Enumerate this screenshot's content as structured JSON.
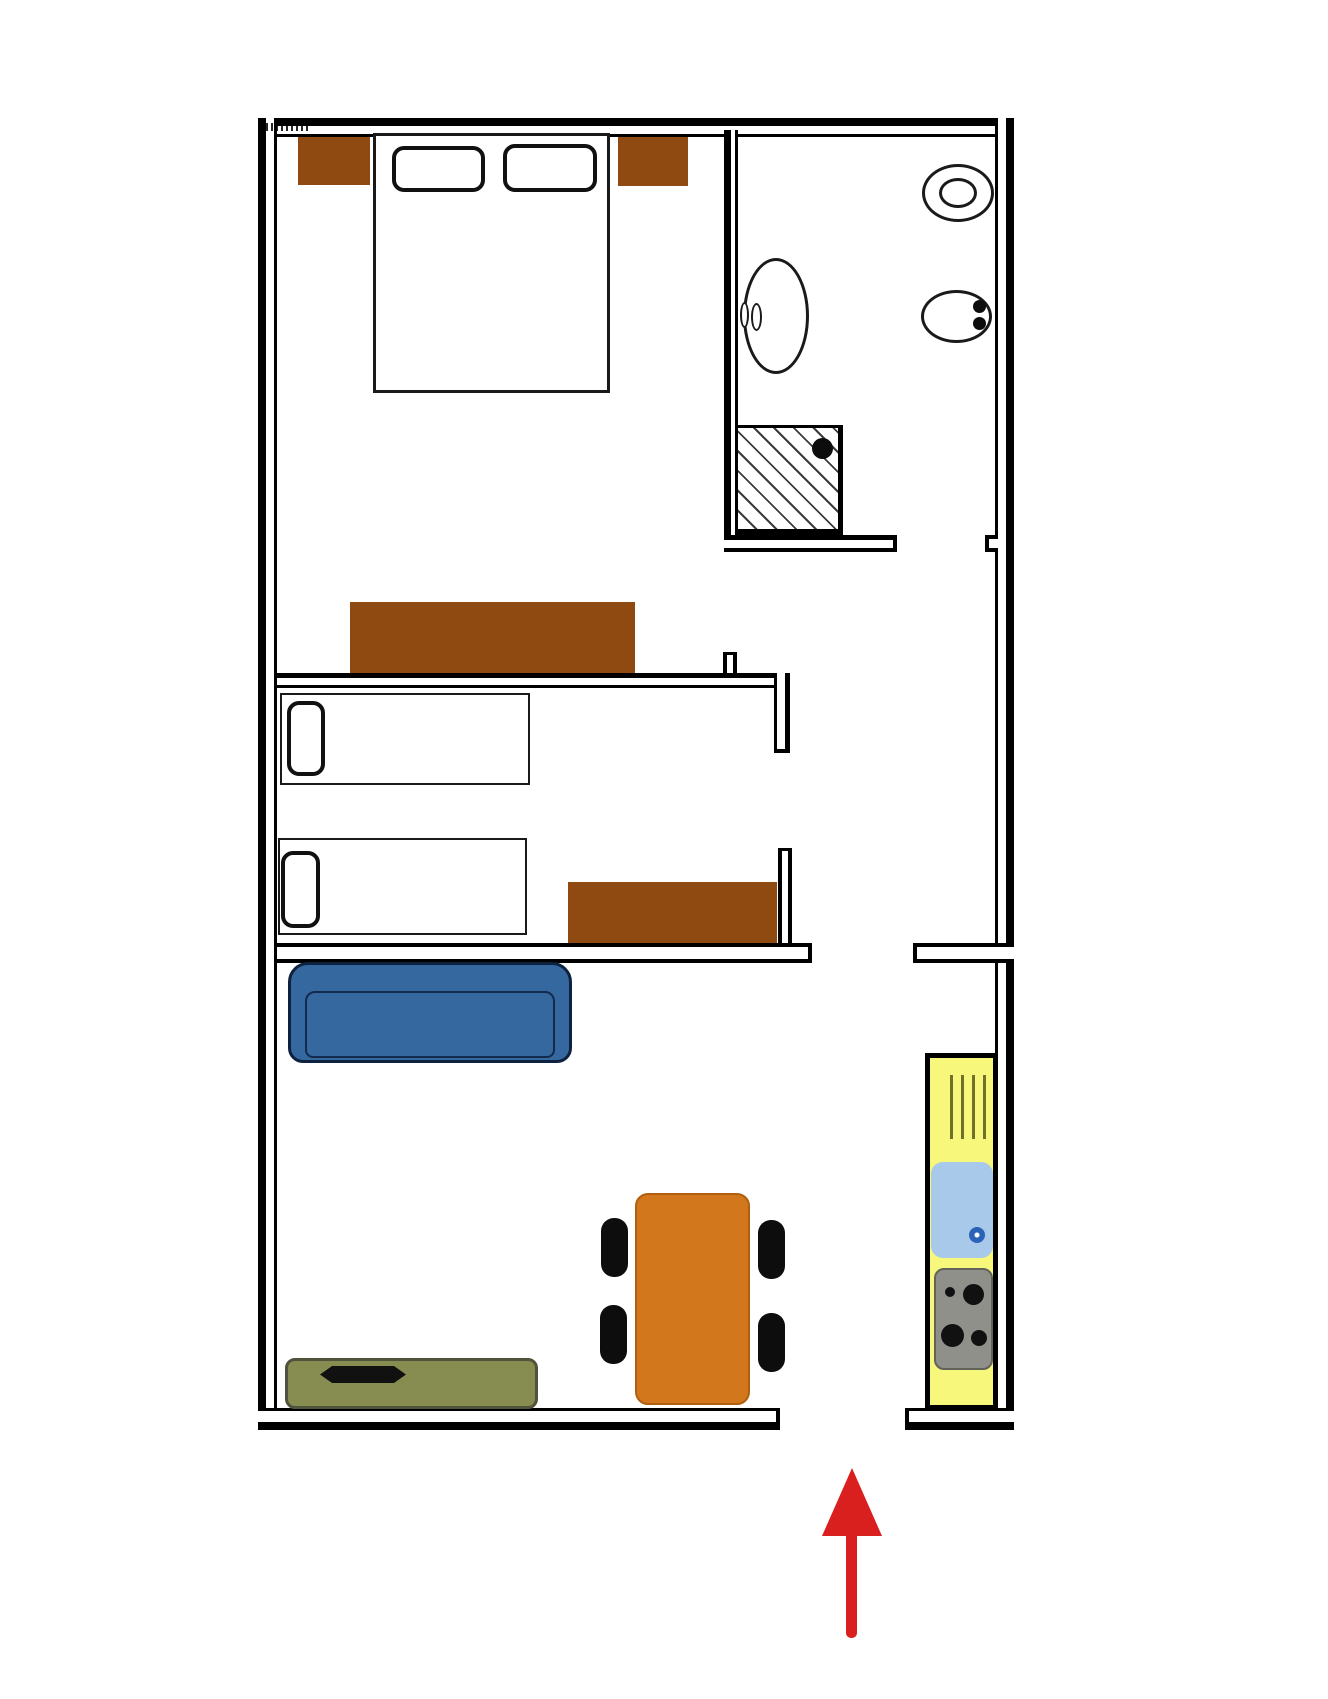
{
  "plan": {
    "type": "apartment floor plan, top-down view",
    "rooms": [
      "master-bedroom",
      "bathroom",
      "second-bedroom",
      "living-room",
      "kitchen-nook",
      "hallway",
      "entrance"
    ],
    "items": [
      "double-bed",
      "pillow-left",
      "pillow-right",
      "nightstand-left",
      "nightstand-right",
      "wardrobe-dresser",
      "wash-basin",
      "tap",
      "toilet-upper",
      "toilet-lower",
      "shower-cabin",
      "shower-head",
      "single-bed-upper",
      "single-bed-upper-pillow",
      "single-bed-lower",
      "single-bed-lower-pillow",
      "dresser-second-bedroom",
      "sofa",
      "tv-bench",
      "tv",
      "dining-table",
      "chair-1",
      "chair-2",
      "chair-3",
      "chair-4",
      "kitchen-counter",
      "dish-rack",
      "kitchen-sink",
      "sink-drain",
      "stove",
      "burner-1",
      "burner-2",
      "burner-3",
      "burner-4",
      "entrance-arrow",
      "corner-mark"
    ]
  },
  "colors": {
    "background": "#ffffff",
    "wall": "#000000",
    "wood": "#8e4a10",
    "bed_fill": "#ffffff",
    "outline": "#1a1a1a",
    "sofa": "#35689f",
    "sofa_border": "#0e2240",
    "table": "#d2771c",
    "chair": "#0d0d0d",
    "bench": "#878c50",
    "bench_border": "#50543c",
    "tv": "#111111",
    "kitchen_counter": "#f7f77c",
    "kitchen_sink": "#a9c9ea",
    "sink_drain": "#2a62b8",
    "stove": "#90908a",
    "burner": "#111111",
    "dish_rack": "#70702a",
    "entrance_arrow": "#da1f1f"
  }
}
